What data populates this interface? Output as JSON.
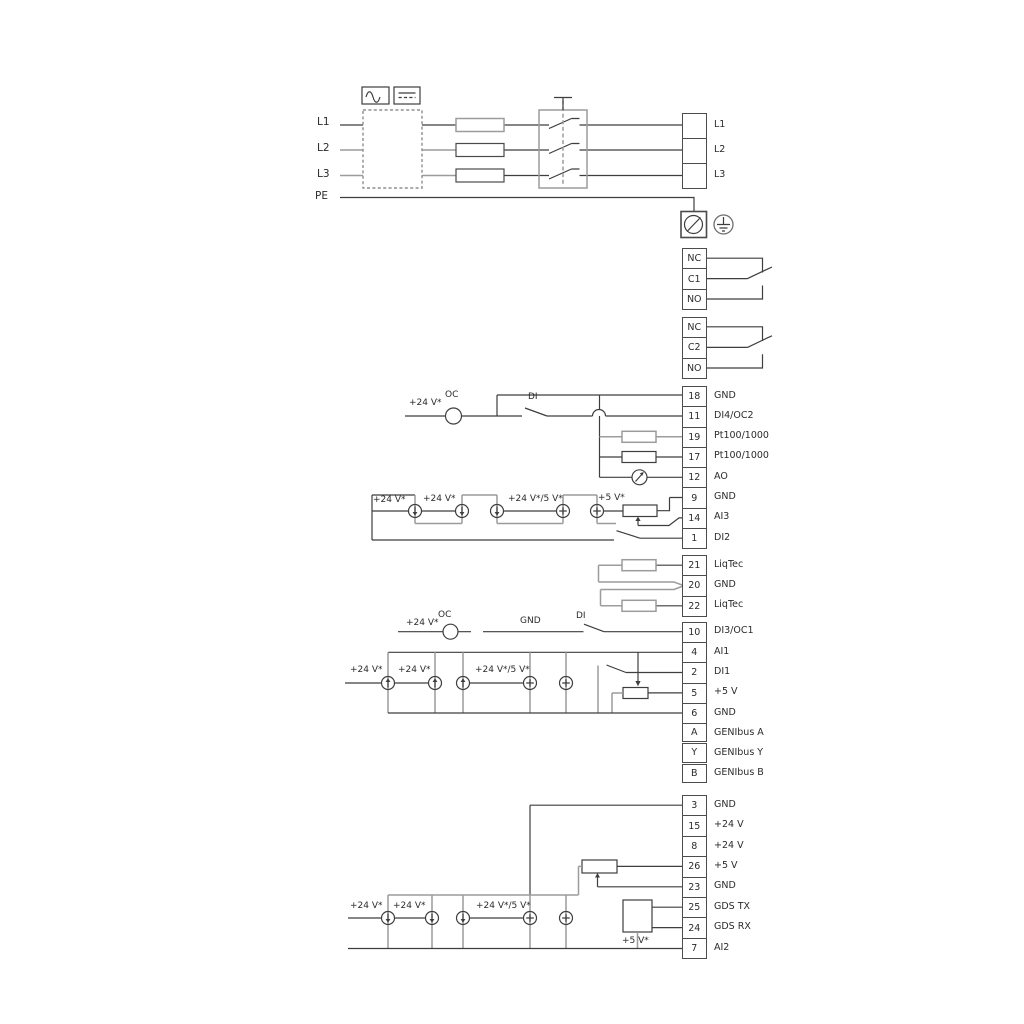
{
  "labels": {
    "v24": "+24 V*",
    "v24_5": "+24 V*/5 V*",
    "v5": "+5 V*",
    "oc": "OC",
    "di": "DI",
    "gnd": "GND"
  },
  "power": {
    "left": [
      "L1",
      "L2",
      "L3",
      "PE"
    ]
  },
  "strips": {
    "power": {
      "cells": [
        {
          "num": "",
          "label": "L1"
        },
        {
          "num": "",
          "label": "L2"
        },
        {
          "num": "",
          "label": "L3"
        }
      ]
    },
    "relay1": {
      "cells": [
        {
          "num": "NC"
        },
        {
          "num": "C1"
        },
        {
          "num": "NO"
        }
      ]
    },
    "relay2": {
      "cells": [
        {
          "num": "NC"
        },
        {
          "num": "C2"
        },
        {
          "num": "NO"
        }
      ]
    },
    "io1": {
      "cells": [
        {
          "num": "18",
          "label": "GND"
        },
        {
          "num": "11",
          "label": "DI4/OC2"
        },
        {
          "num": "19",
          "label": "Pt100/1000"
        },
        {
          "num": "17",
          "label": "Pt100/1000"
        },
        {
          "num": "12",
          "label": "AO"
        },
        {
          "num": "9",
          "label": "GND"
        },
        {
          "num": "14",
          "label": "AI3"
        },
        {
          "num": "1",
          "label": "DI2"
        }
      ]
    },
    "liqtec": {
      "cells": [
        {
          "num": "21",
          "label": "LiqTec"
        },
        {
          "num": "20",
          "label": "GND"
        },
        {
          "num": "22",
          "label": "LiqTec"
        }
      ]
    },
    "di3": {
      "cells": [
        {
          "num": "10",
          "label": "DI3/OC1"
        }
      ]
    },
    "ai1": {
      "cells": [
        {
          "num": "4",
          "label": "AI1"
        },
        {
          "num": "2",
          "label": "DI1"
        },
        {
          "num": "5",
          "label": "+5 V"
        },
        {
          "num": "6",
          "label": "GND"
        }
      ]
    },
    "genibus": {
      "cells": [
        {
          "num": "A",
          "label": "GENIbus A"
        },
        {
          "num": "Y",
          "label": "GENIbus Y"
        },
        {
          "num": "B",
          "label": "GENIbus B"
        }
      ]
    },
    "bottom": {
      "cells": [
        {
          "num": "3",
          "label": "GND"
        },
        {
          "num": "15",
          "label": "+24 V"
        },
        {
          "num": "8",
          "label": "+24 V"
        },
        {
          "num": "26",
          "label": "+5 V"
        },
        {
          "num": "23",
          "label": "GND"
        },
        {
          "num": "25",
          "label": "GDS TX"
        },
        {
          "num": "24",
          "label": "GDS RX"
        },
        {
          "num": "7",
          "label": "AI2"
        }
      ]
    }
  }
}
